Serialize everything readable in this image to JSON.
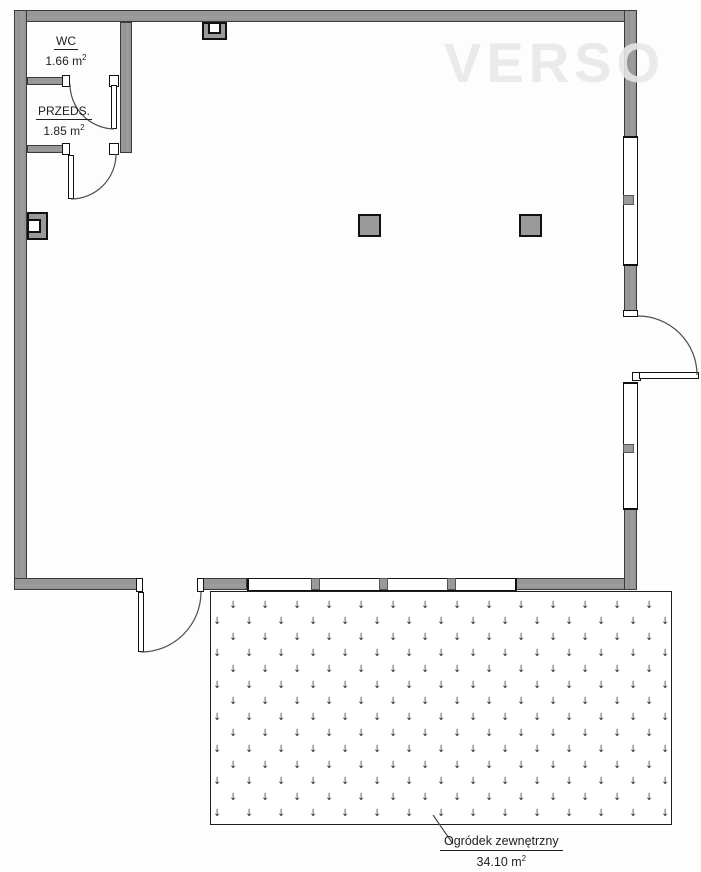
{
  "watermark": "VERSO",
  "rooms": {
    "wc": {
      "name": "WC",
      "area": "1.66 m",
      "area_sup": "2"
    },
    "przeds": {
      "name": "PRZEDS.",
      "area": "1.85 m",
      "area_sup": "2"
    },
    "garden": {
      "name": "Ogródek zewnętrzny",
      "area": "34.10 m",
      "area_sup": "2"
    }
  },
  "pattern_symbol": "↓",
  "colors": {
    "wall_fill": "#9a9a9a",
    "wall_edge": "#3a3a3a",
    "line": "#111111",
    "watermark": "#e7e7e7",
    "background": "#ffffff"
  }
}
